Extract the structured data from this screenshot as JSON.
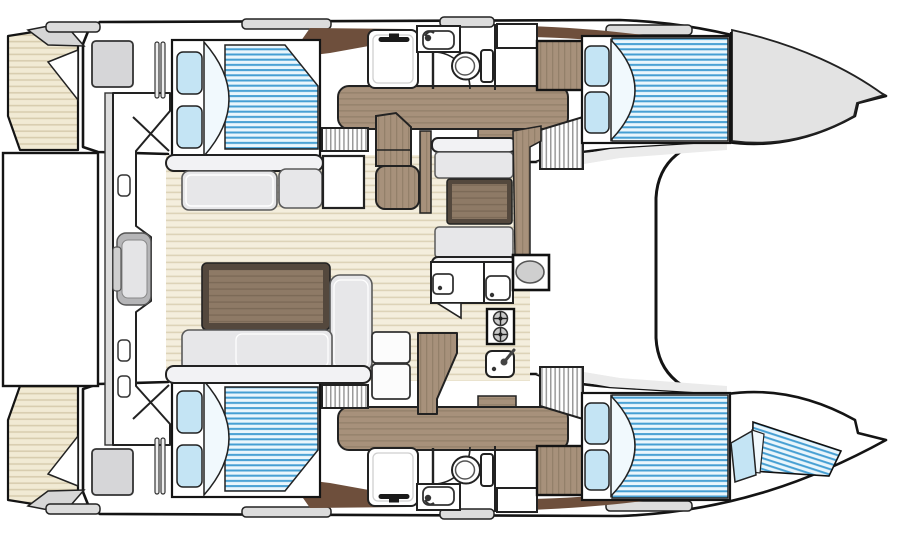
{
  "diagram": {
    "title": "catamaran-interior-floorplan",
    "view": "top-down",
    "bow_direction": "right",
    "areas": [
      {
        "name": "port-hull-aft-cabin",
        "fixtures": [
          "double-bed",
          "pillows-x2",
          "duvet-fold",
          "wardrobe-locker",
          "slatted-door"
        ]
      },
      {
        "name": "port-hull-bathroom",
        "fixtures": [
          "shower-tray",
          "shower-mixer",
          "washbasin",
          "faucet",
          "toilet",
          "door-swing",
          "cabinet",
          "wood-wardrobe"
        ]
      },
      {
        "name": "port-hull-forward-cabin",
        "fixtures": [
          "double-bed",
          "pillows-x2",
          "duvet-fold",
          "side-shelf",
          "bow-locker"
        ]
      },
      {
        "name": "port-hull-passageway",
        "fixtures": [
          "wood-sole",
          "companionway-steps-x2"
        ]
      },
      {
        "name": "starboard-hull-aft-cabin",
        "fixtures": [
          "double-bed",
          "pillows-x2",
          "duvet-fold",
          "wardrobe-locker",
          "slatted-door"
        ]
      },
      {
        "name": "starboard-hull-bathroom",
        "fixtures": [
          "shower-tray",
          "shower-mixer",
          "washbasin",
          "faucet",
          "toilet",
          "door-swing",
          "cabinet",
          "wood-wardrobe"
        ]
      },
      {
        "name": "starboard-hull-forward-cabin",
        "fixtures": [
          "double-bed",
          "pillows-x2",
          "duvet-fold",
          "forepeak-berth",
          "berth-pillow"
        ]
      },
      {
        "name": "starboard-hull-passageway",
        "fixtures": [
          "wood-sole",
          "companionway-steps-x2"
        ]
      },
      {
        "name": "salon",
        "fixtures": [
          "aft-bench",
          "bench-cushions-x2",
          "side-table",
          "coffee-table",
          "l-shaped-sofa",
          "chaise",
          "chart-desk",
          "chart-seat"
        ]
      },
      {
        "name": "dinette",
        "fixtures": [
          "forward-bench",
          "table",
          "aft-bench"
        ]
      },
      {
        "name": "galley",
        "fixtures": [
          "counter-sink-x2",
          "two-burner-stove",
          "sink-with-faucet",
          "oval-basin-console",
          "wood-island",
          "fridge-units-x2"
        ]
      },
      {
        "name": "aft-cockpit",
        "fixtures": [
          "swim-platform",
          "transom-panel",
          "helm-seat",
          "grab-handles-x3",
          "rail"
        ]
      },
      {
        "name": "transoms",
        "fixtures": [
          "teak-steps-port",
          "teak-steps-starboard"
        ]
      },
      {
        "name": "foredeck",
        "fixtures": [
          "coachroof-front",
          "deck-bars"
        ]
      }
    ],
    "counts": {
      "double_beds": 4,
      "single_berths": 1,
      "toilets": 2,
      "showers": 2,
      "washbasins": 2,
      "galley_sinks": 4,
      "stove_burners": 2,
      "companionway_steps": 4
    },
    "colors": {
      "outline": "#141414",
      "hull": "#ffffff",
      "grayFill": "#e3e3e3",
      "grayBar": "#dcdcdc",
      "floorBg": "#f4eedd",
      "floorLine": "#ddd3b8",
      "teakBg": "#f1ead4",
      "teakLine": "#d8cdaf",
      "mattBg": "#eaf6fc",
      "mattLine": "#459fd3",
      "pillow": "#c4e4f4",
      "duvet": "#f1f9fd",
      "woodMid": "#a7917b",
      "woodGrain": "#93806a",
      "woodDark": "#6e4f3c",
      "tableEdge": "#54483d",
      "tableTop": "#8e7a66",
      "tableGrain": "#7c6a57",
      "sofa": "#e7e7e9",
      "sofaEdge": "#5a5a5a",
      "barFill": "#f2f2f4",
      "hatch": "#9a9a9a",
      "fixGray": "#d6d6d8",
      "seatGray": "#b5b5b7"
    }
  }
}
